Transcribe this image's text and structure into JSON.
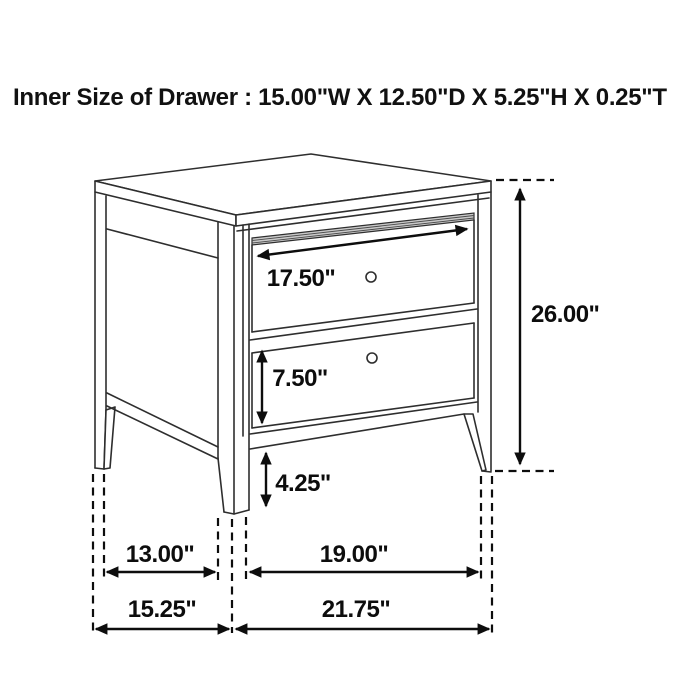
{
  "title": "Inner Size of Drawer : 15.00\"W X 12.50\"D X 5.25\"H X 0.25\"T",
  "product": "two-drawer nightstand dimension drawing",
  "dims": {
    "top_drawer_width": "17.50\"",
    "overall_height": "26.00\"",
    "bottom_drawer_height": "7.50\"",
    "floor_clearance": "4.25\"",
    "side_inner_span": "13.00\"",
    "front_inner_span": "19.00\"",
    "overall_depth": "15.25\"",
    "overall_width": "21.75\""
  },
  "inner_drawer_size": {
    "width": "15.00\"W",
    "depth": "12.50\"D",
    "height": "5.25\"H",
    "thickness": "0.25\"T"
  },
  "colors": {
    "background": "#ffffff",
    "line": "#2e2e2e",
    "dimension": "#0d0d0d",
    "band_fill": "#c9c9c9"
  }
}
